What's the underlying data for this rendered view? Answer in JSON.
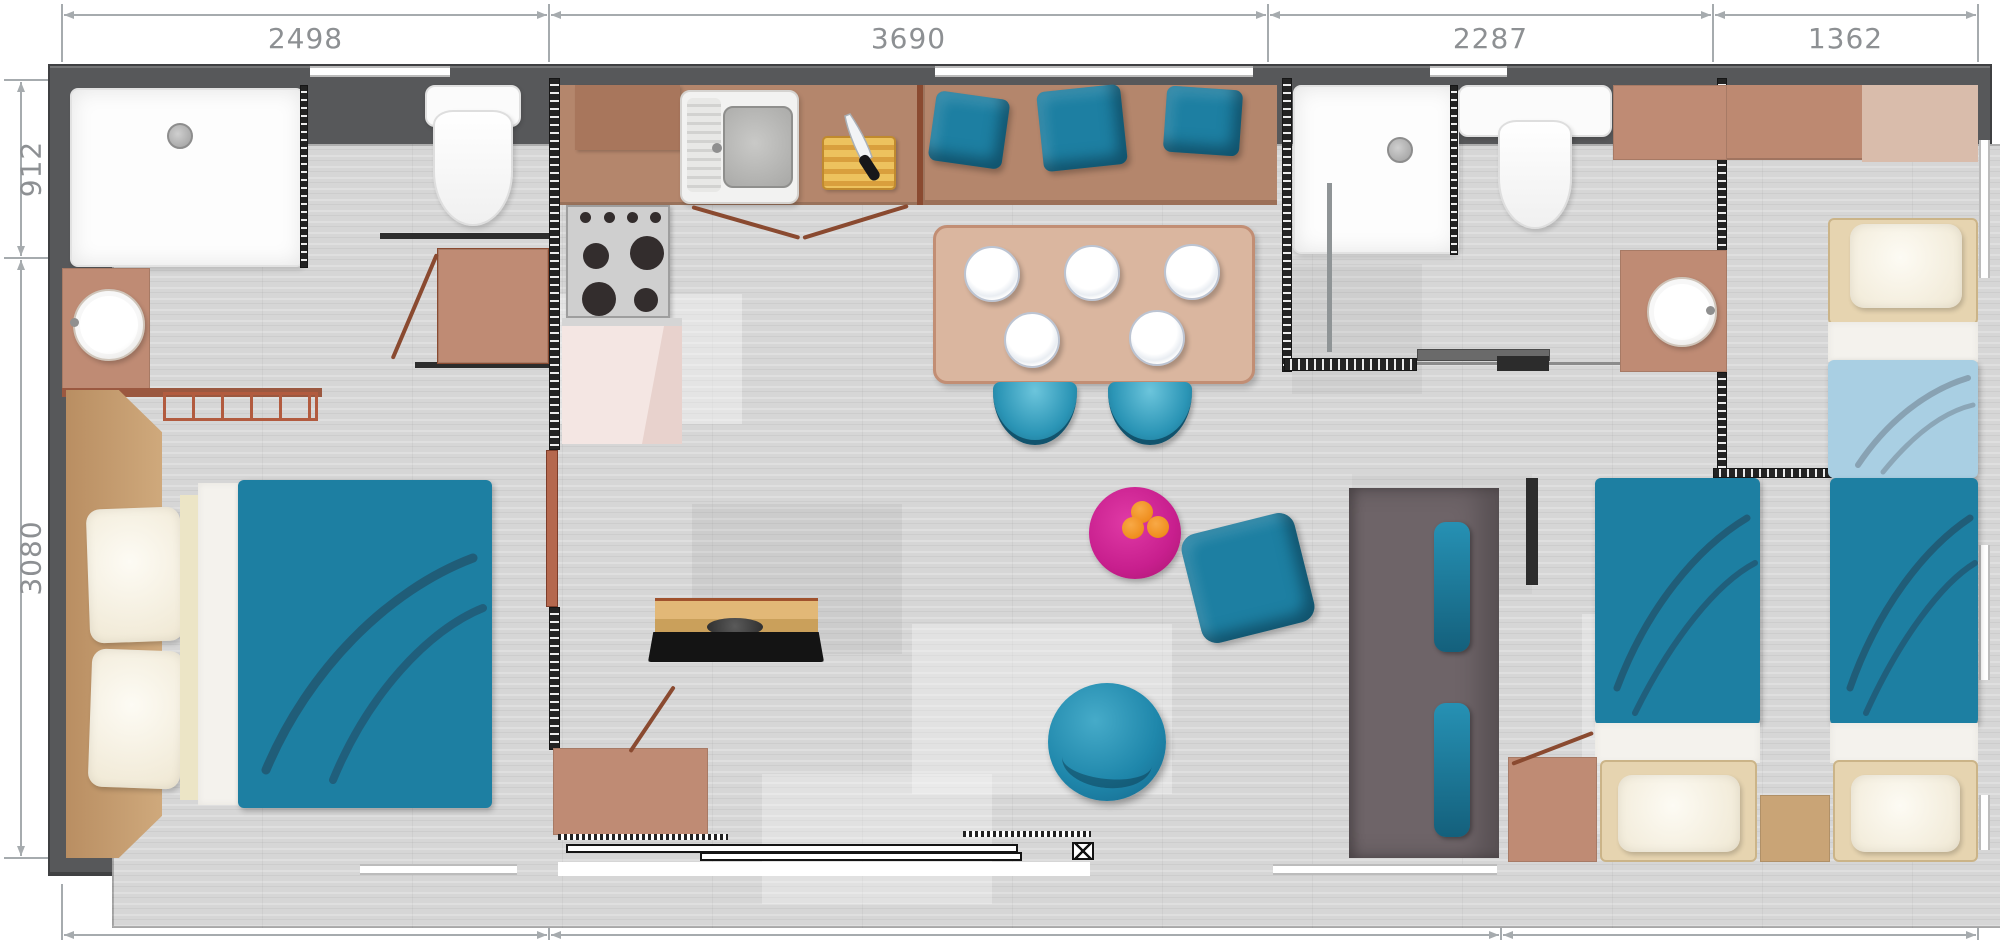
{
  "diagram": {
    "type": "floor-plan",
    "subject": "mobile-home-top-view",
    "units": "mm",
    "dimensions": {
      "top": [
        "2498",
        "3690",
        "2287",
        "1362"
      ],
      "bottom": [
        "2498",
        "4888",
        "2470"
      ],
      "left": [
        "912",
        "3080"
      ]
    },
    "rooms": [
      "bathroom-1",
      "master-bedroom",
      "kitchen",
      "dining-area",
      "living-area",
      "bathroom-2",
      "hallway",
      "twin-bedroom",
      "single-bedroom"
    ],
    "furniture": [
      "shower-tray",
      "round-sink",
      "toilet",
      "wardrobe",
      "double-bed",
      "pillows",
      "radiator-bench",
      "kitchen-sink",
      "stove",
      "fridge",
      "cutting-board",
      "knife",
      "sofa-bench",
      "seat-cushions",
      "dining-table",
      "plates",
      "chairs",
      "tv-shelf",
      "tv",
      "round-rug",
      "oranges",
      "armchair",
      "round-pouf",
      "sliding-bay-door",
      "storage-unit",
      "single-beds",
      "nightstand",
      "bedside-cabinet"
    ]
  },
  "colors": {
    "wall": "#57585a",
    "floor": "#d6d6d6",
    "dim-text": "#8d9093",
    "dim-line": "#a6abae",
    "teal": "#1d7fa2",
    "teal-bright": "#2f9cbd",
    "lightblue": "#a9cfe3",
    "counter-brown": "#b4866c",
    "cabinet-brown": "#a8765c",
    "salmon": "#bf8b74",
    "table-tan": "#dab69f",
    "table-border": "#c28e74",
    "tan-frame": "#e6d4b0",
    "tan-wood": "#c9a476",
    "headboard": "#c49c6d",
    "magenta": "#c81f8e",
    "orange": "#ef8e1e",
    "wood-top": "#d8a863",
    "wood-edge": "#8a4a28",
    "door-red": "#8a4a30",
    "gray-unit": "#6e6468",
    "fridge-pink": "#f4e6e3",
    "stove-gray": "#cfcfcf",
    "burner": "#332d2d"
  }
}
